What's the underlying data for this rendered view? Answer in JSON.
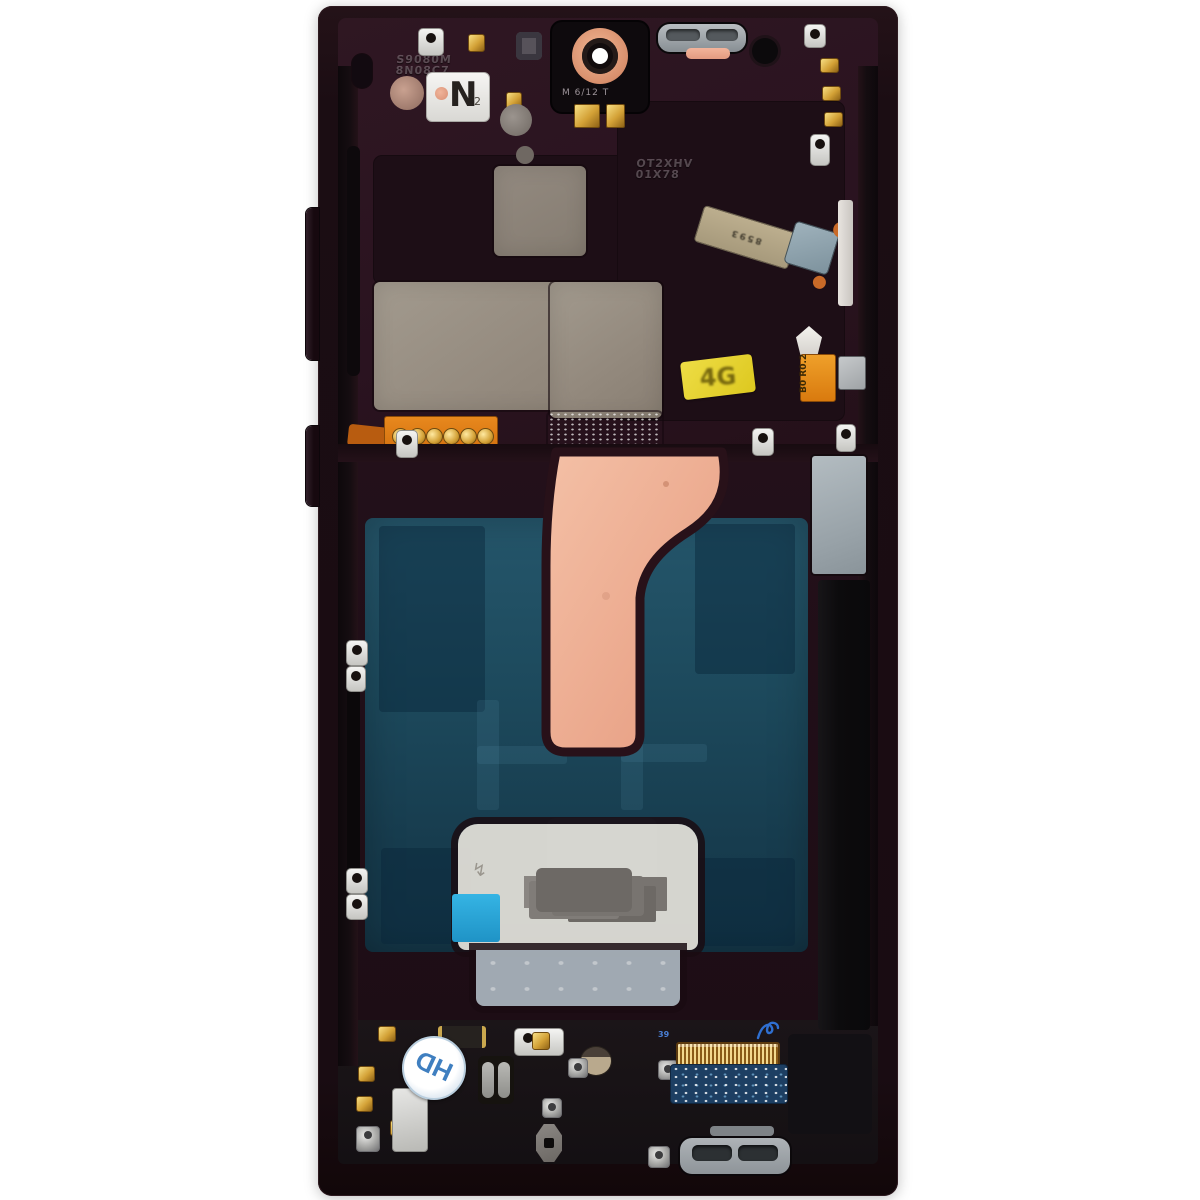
{
  "photo": {
    "subject": "Smartphone mid-frame and display assembly, internal side, product photo on white background",
    "markings": {
      "embossed_top_left_1": "S9080M",
      "embossed_top_left_2": "8N08C7",
      "nfc": "N",
      "nfc_sub": "2",
      "camera_housing": "M 6/12 T",
      "embossed_center_1": "OT2XHV",
      "embossed_center_2": "01X78",
      "sticker_4g": "4G",
      "orange_chip_line1": "B0",
      "orange_chip_line2": "R0.2",
      "diagonal_flex_code": "8593",
      "hd_sticker": "HD",
      "connector_index": "39"
    },
    "colors": {
      "background": "#ffffff",
      "frame": "#1b0e14",
      "deck_plum": "#2b1520",
      "copper_flex": "#eeb096",
      "display_back_teal": "#1e4757",
      "thermal_plate_taupe": "#968c81",
      "frost_label": "#dcd8d0",
      "blue_pull_tab": "#2aa8d9",
      "sticker_yellow": "#e6d22f",
      "orange_flex": "#d4720f",
      "gold_contact": "#e8c45a",
      "hd_blue": "#3f7fc0",
      "connector_gold": "#c98f2a"
    }
  }
}
